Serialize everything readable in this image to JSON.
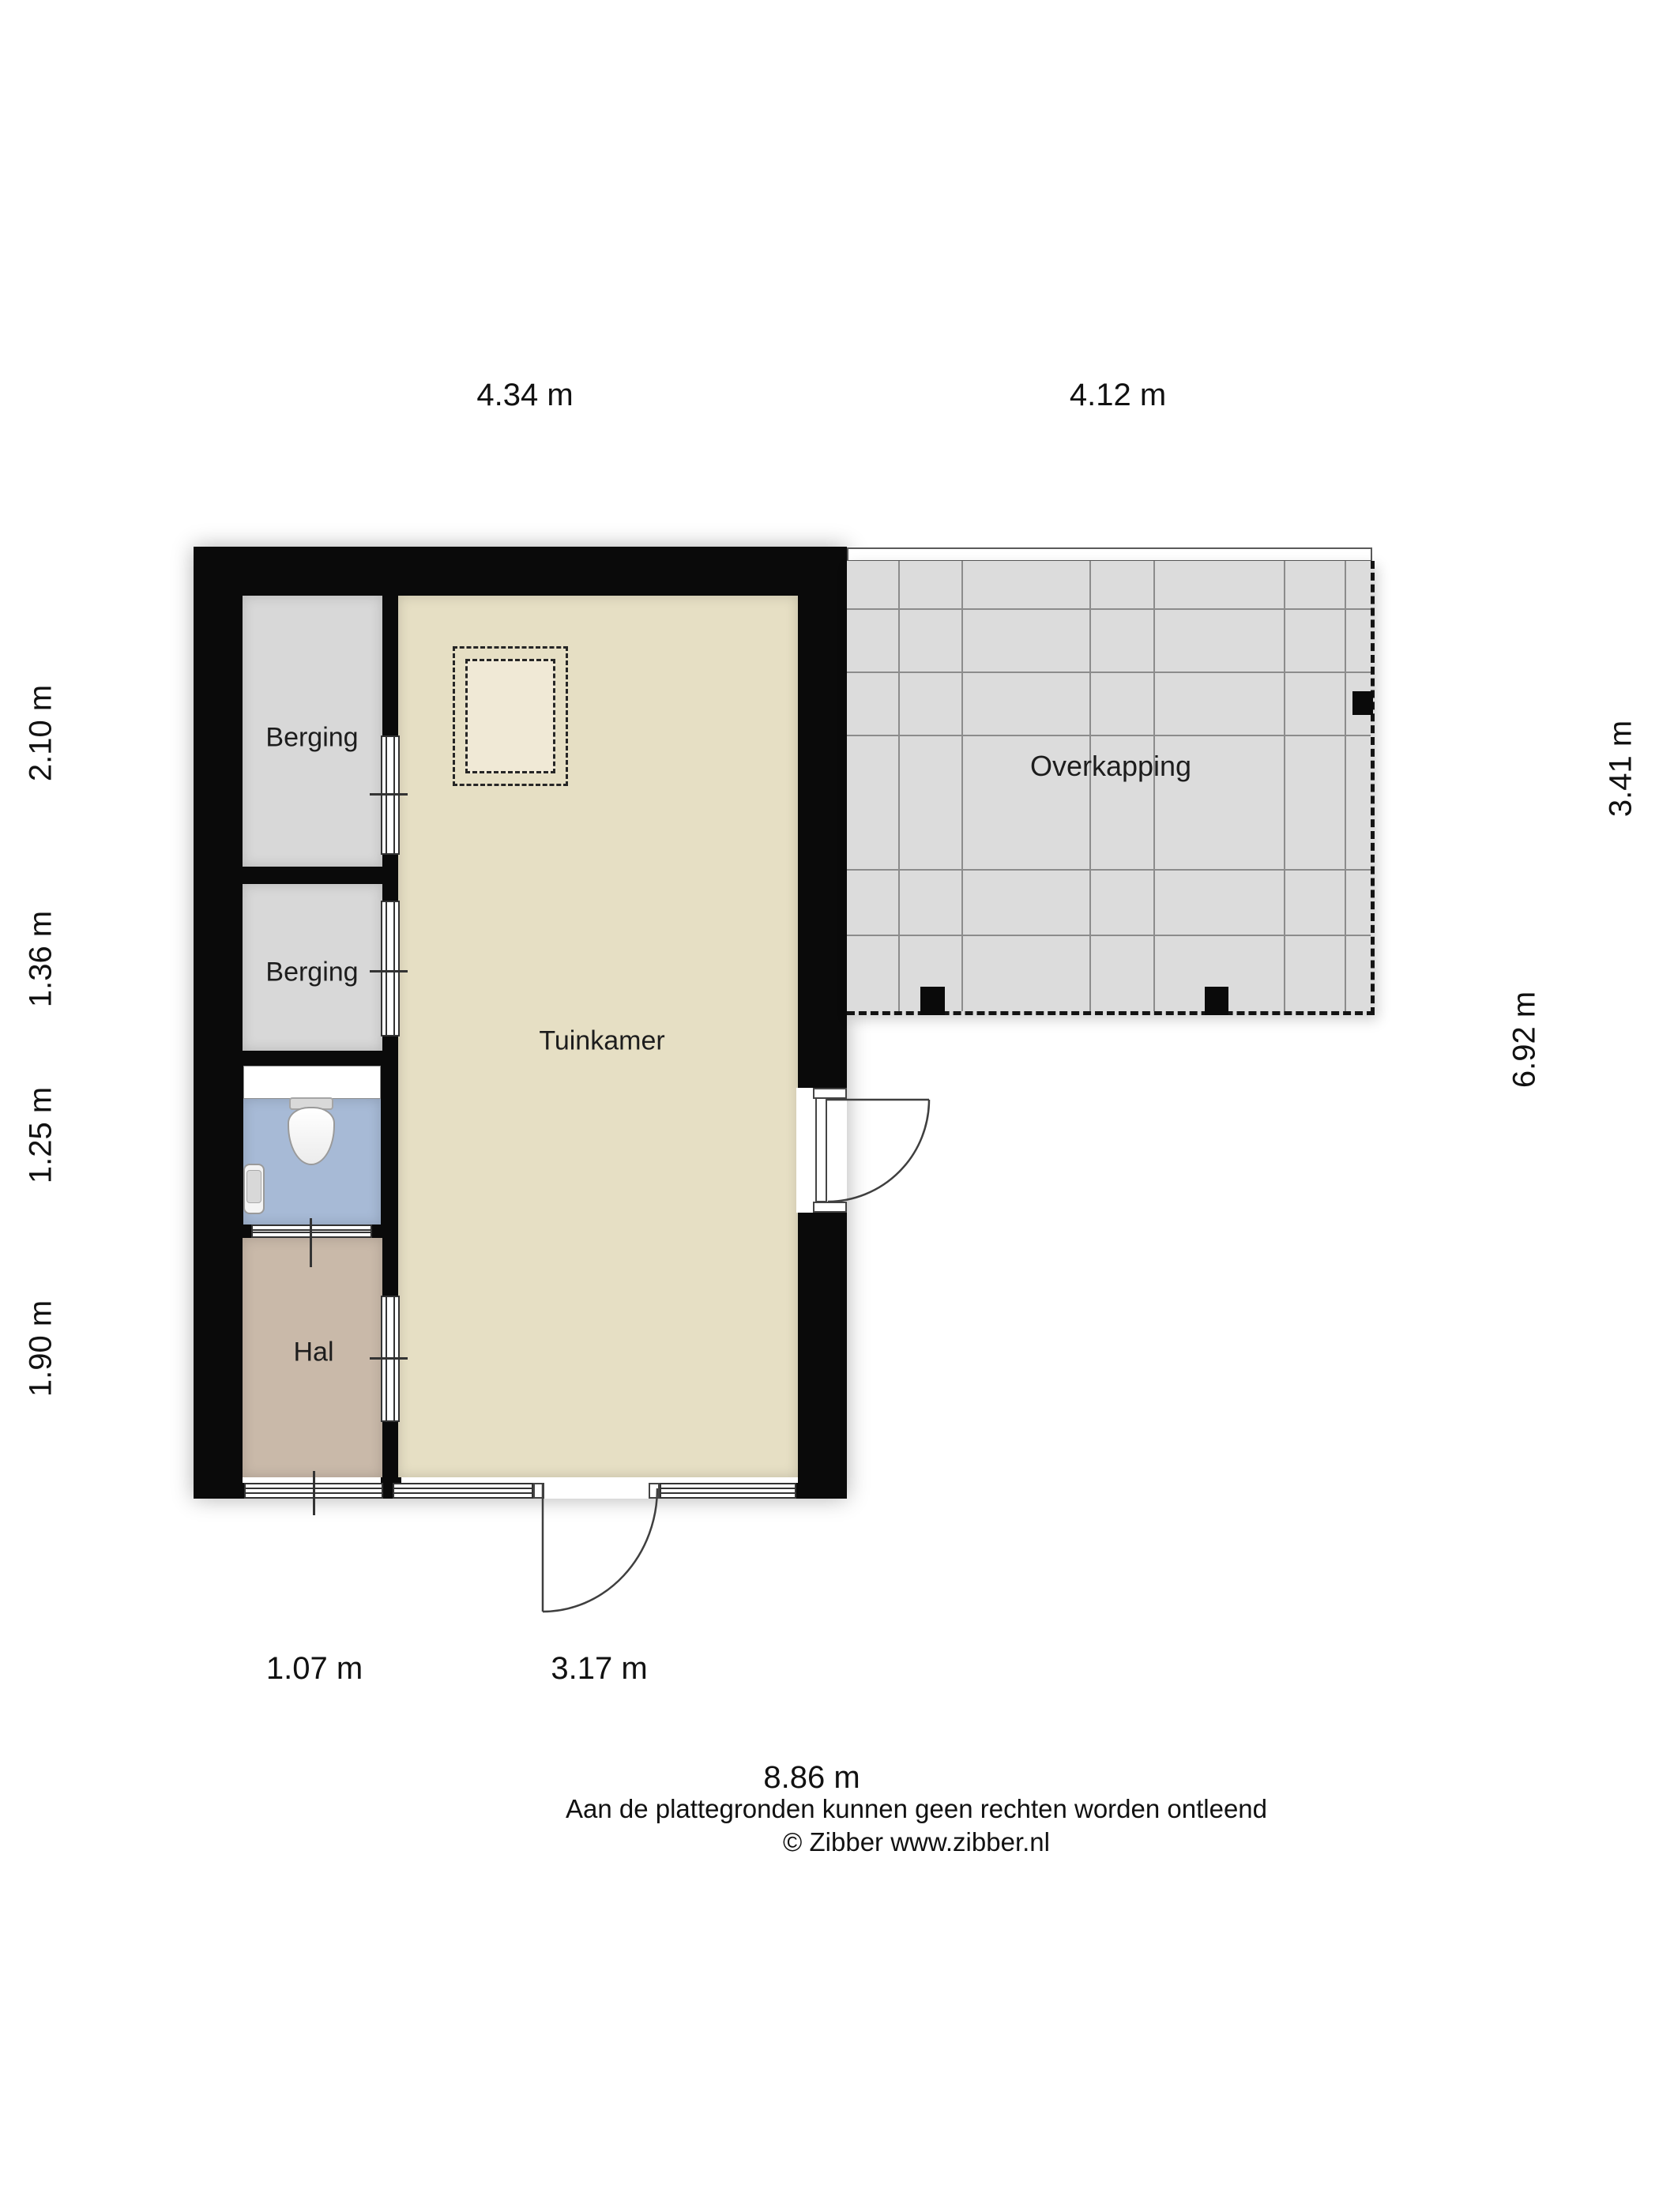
{
  "rooms": {
    "berging_top": "Berging",
    "berging_bottom": "Berging",
    "tuinkamer": "Tuinkamer",
    "hal": "Hal",
    "overkapping": "Overkapping"
  },
  "dimensions": {
    "top_inner_width": "4.34 m",
    "overkapping_width": "4.12 m",
    "left_segments": [
      "2.10 m",
      "1.36 m",
      "1.25 m",
      "1.90 m"
    ],
    "inner_height": "6.92 m",
    "overkapping_height": "3.41 m",
    "hal_width": "1.07 m",
    "tuinkamer_width": "3.17 m",
    "total_width": "8.86 m"
  },
  "footer": {
    "disclaimer": "Aan de plattegronden kunnen geen rechten worden ontleend",
    "copyright": "© Zibber www.zibber.nl"
  },
  "colors": {
    "wall": "#0a0a0a",
    "storage_room": "#d8d8d8",
    "garden_room": "#e6dfc4",
    "hall": "#c9b9a9",
    "toilet": "#a7bad6",
    "canopy": "#dcdcdc",
    "dimension": "#1f1f1f"
  }
}
